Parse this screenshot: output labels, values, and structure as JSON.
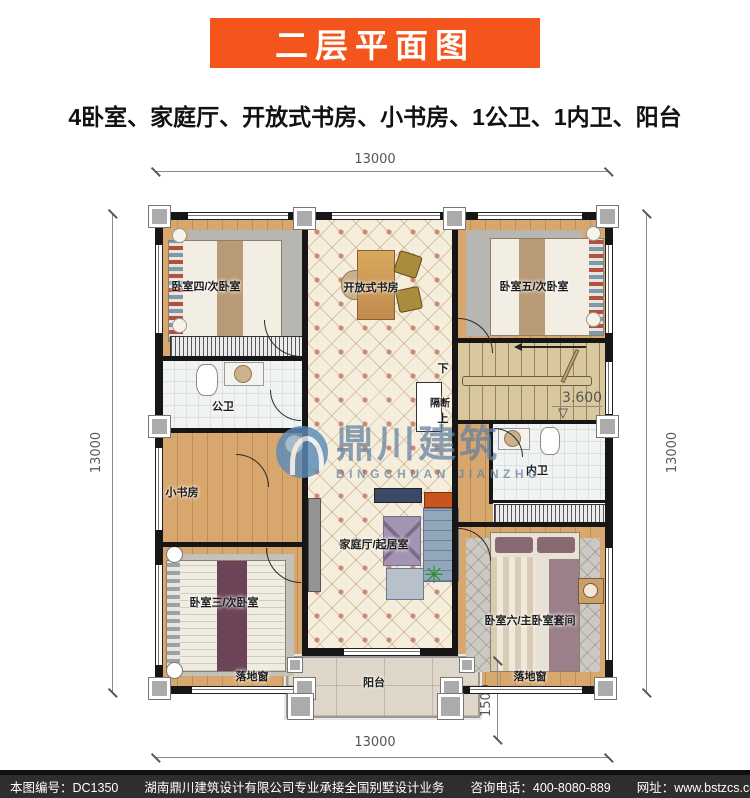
{
  "header": {
    "title": "二层平面图",
    "subtitle": "4卧室、家庭厅、开放式书房、小书房、1公卫、1内卫、阳台"
  },
  "plan": {
    "dims": {
      "top": "13000",
      "bottom": "13000",
      "left": "13000",
      "right": "13000",
      "balcony_depth": "1500"
    },
    "level": "3.600",
    "level_symbol": "▽",
    "stair_down": "下",
    "stair_up": "上",
    "rooms": {
      "bedroom4": "卧室四/次卧室",
      "open_study": "开放式书房",
      "bedroom5": "卧室五/次卧室",
      "public_bath": "公卫",
      "partition": "隔断",
      "small_study": "小书房",
      "inner_bath": "内卫",
      "family_hall": "家庭厅/起居室",
      "bedroom3": "卧室三/次卧室",
      "bedroom6": "卧室六/主卧室套间",
      "balcony": "阳台",
      "french_window_left": "落地窗",
      "french_window_right": "落地窗"
    }
  },
  "watermark": {
    "cn": "鼎川建筑",
    "en": "DINGCHUAN JIANZHU"
  },
  "footer": {
    "serial": "本图编号：DC1350",
    "company": "湖南鼎川建筑设计有限公司专业承接全国别墅设计业务",
    "phone": "咨询电话：400-8080-889",
    "site": "网址：www.bstzcs.com"
  },
  "colors": {
    "accent": "#F4551C",
    "wall": "#161616",
    "wood": "#D8A76E",
    "tile": "#F6EEDD",
    "footer_bg": "#2E2E2E",
    "watermark_blue": "#6E8CA8"
  }
}
